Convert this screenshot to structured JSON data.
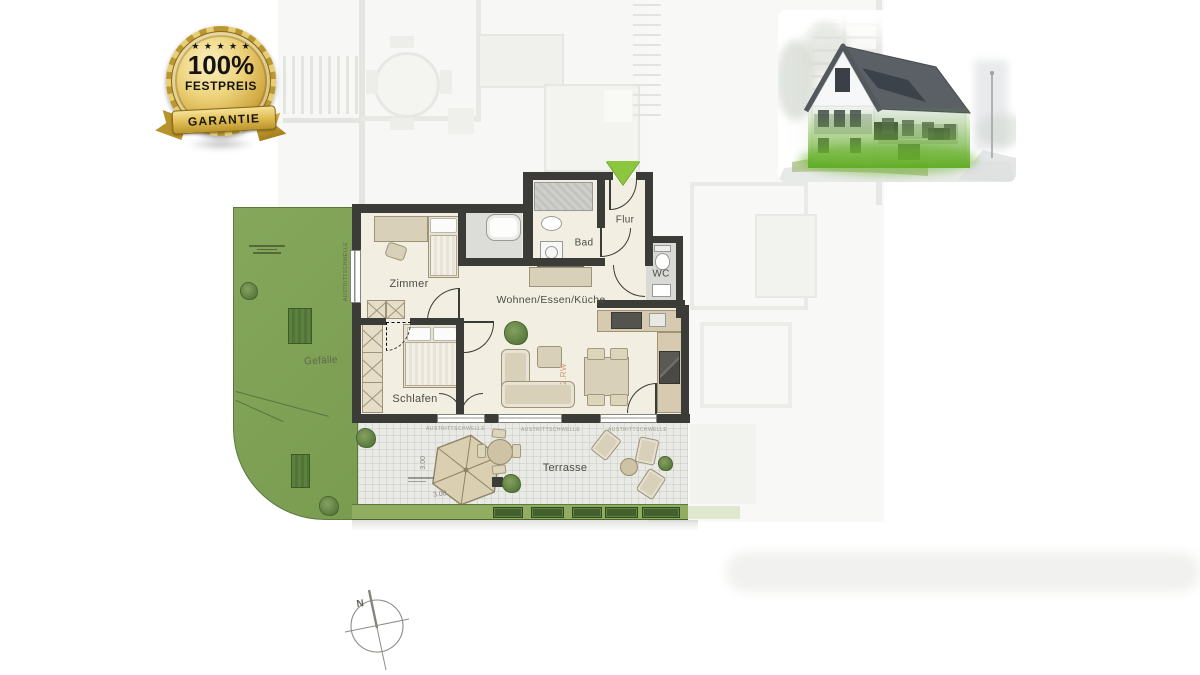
{
  "badge": {
    "stars": "★ ★ ★ ★ ★",
    "headline": "100%",
    "subline": "FESTPREIS",
    "ribbon": "GARANTIE"
  },
  "plan": {
    "rooms": [
      {
        "id": "zimmer",
        "label": "Zimmer"
      },
      {
        "id": "schlafen",
        "label": "Schlafen"
      },
      {
        "id": "wohnen-essen-kueche",
        "label": "Wohnen/Essen/Küche"
      },
      {
        "id": "bad",
        "label": "Bad"
      },
      {
        "id": "flur",
        "label": "Flur"
      },
      {
        "id": "wc",
        "label": "WC"
      },
      {
        "id": "terrasse",
        "label": "Terrasse"
      }
    ],
    "annotations": {
      "slope_label": "Gefälle",
      "threshold_label": "AUSTRITTSCHWELLE",
      "escape_route_label": "2.RW",
      "terrace_width": "3.00",
      "terrace_depth": "3.00",
      "north_label": "N"
    }
  },
  "colors": {
    "wall": "#3b3b38",
    "floor": "#f2eee2",
    "garden-green": "#7fa257",
    "hedge-green": "#90ad62",
    "hedge-dark": "#42612c",
    "terrace-gray": "#e9e9e5",
    "furniture-beige": "#d9d0ba",
    "furniture-stroke": "#9d9478",
    "entry-green": "#8cc63e",
    "escape-orange": "#d09a70",
    "badge-gold": "#d4af37"
  }
}
